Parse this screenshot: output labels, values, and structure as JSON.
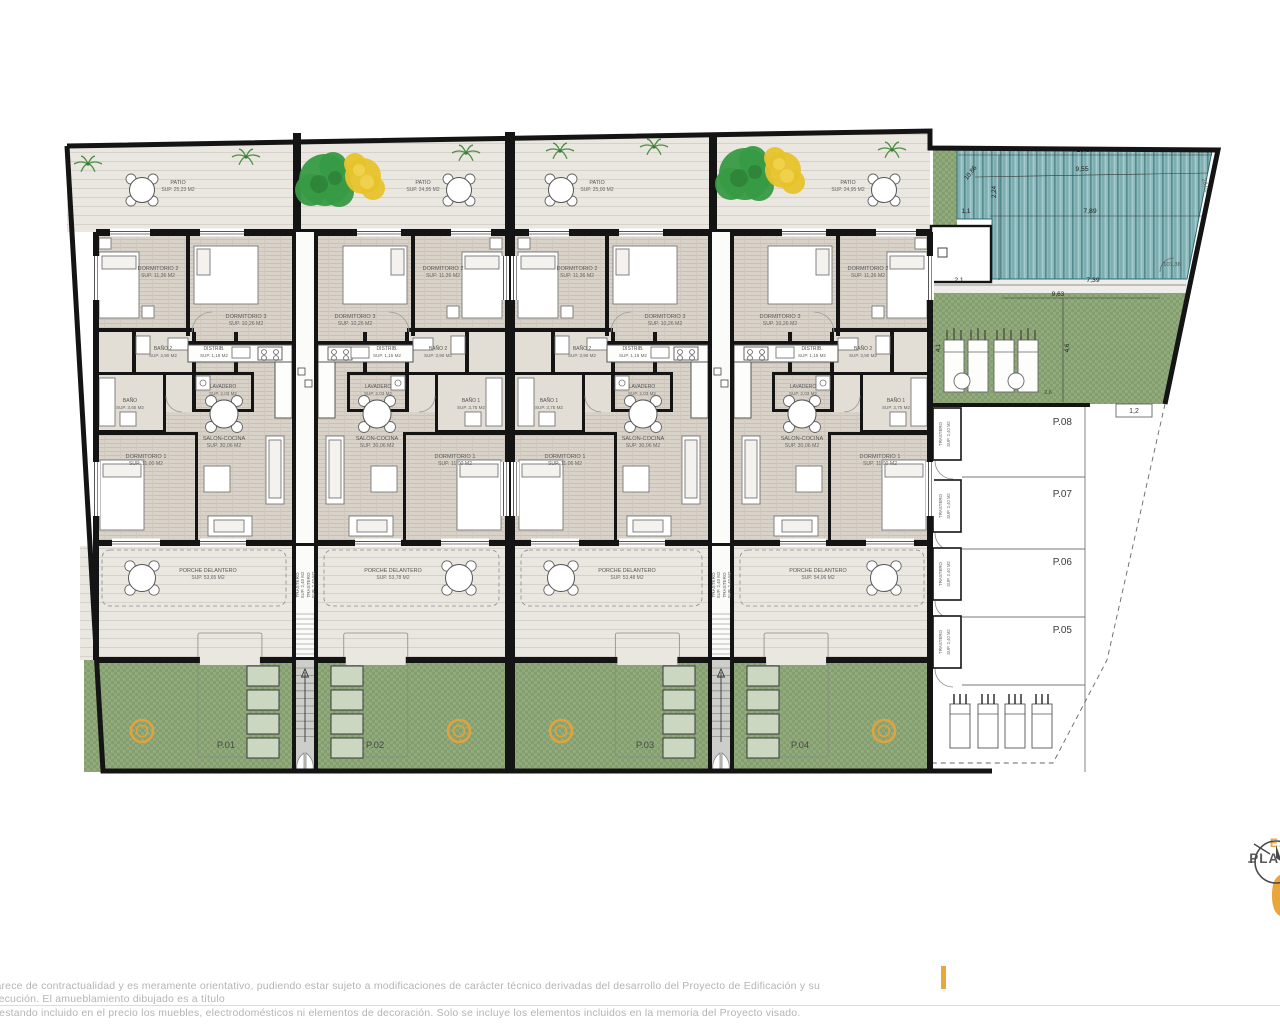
{
  "plan": {
    "units": [
      {
        "id": "P.01",
        "patio": {
          "name": "PATIO",
          "sup": "SUP. 25,23 M2"
        },
        "porche": {
          "name": "PORCHE DELANTERO",
          "sup": "SUP. 53,65 M2"
        },
        "rooms": {
          "dorm2": {
            "name": "DORMITORIO 2",
            "sup": "SUP. 11,36 M2"
          },
          "dorm3": {
            "name": "DORMITORIO 3",
            "sup": "SUP. 10,26 M2"
          },
          "bano2": {
            "name": "BAÑO 2",
            "sup": "SUP. 3,90 M2"
          },
          "distrib": {
            "name": "DISTRIB.",
            "sup": "SUP. 1,15 M2"
          },
          "lavadero": {
            "name": "LAVADERO",
            "sup": "SUP. 2,03 M2"
          },
          "banomid": {
            "name": "BAÑO",
            "sup": "SUP. 3,65 M2"
          },
          "dorm1": {
            "name": "DORMITORIO 1",
            "sup": "SUP. 11,00 M2"
          },
          "salon": {
            "name": "SALON-COCINA",
            "sup": "SUP. 30,06 M2"
          }
        }
      },
      {
        "id": "P.02",
        "patio": {
          "name": "PATIO",
          "sup": "SUP. 24,95 M2"
        },
        "porche": {
          "name": "PORCHE DELANTERO",
          "sup": "SUP. 53,78 M2"
        },
        "rooms": {
          "dorm2": {
            "name": "DORMITORIO 2",
            "sup": "SUP. 11,36 M2"
          },
          "dorm3": {
            "name": "DORMITORIO 3",
            "sup": "SUP. 10,26 M2"
          },
          "bano2": {
            "name": "BAÑO 2",
            "sup": "SUP. 3,90 M2"
          },
          "distrib": {
            "name": "DISTRIB.",
            "sup": "SUP. 1,15 M2"
          },
          "lavadero": {
            "name": "LAVADERO",
            "sup": "SUP. 2,03 M2"
          },
          "banomid": {
            "name": "BAÑO 1",
            "sup": "SUP. 3,75 M2"
          },
          "dorm1": {
            "name": "DORMITORIO 1",
            "sup": "SUP. 11,00 M2"
          },
          "salon": {
            "name": "SALON-COCINA",
            "sup": "SUP. 30,06 M2"
          }
        }
      },
      {
        "id": "P.03",
        "patio": {
          "name": "PATIO",
          "sup": "SUP. 25,00 M2"
        },
        "porche": {
          "name": "PORCHE DELANTERO",
          "sup": "SUP. 53,48 M2"
        },
        "rooms": {
          "dorm2": {
            "name": "DORMITORIO 2",
            "sup": "SUP. 11,36 M2"
          },
          "dorm3": {
            "name": "DORMITORIO 3",
            "sup": "SUP. 10,26 M2"
          },
          "bano2": {
            "name": "BAÑO 2",
            "sup": "SUP. 3,90 M2"
          },
          "distrib": {
            "name": "DISTRIB.",
            "sup": "SUP. 1,15 M2"
          },
          "lavadero": {
            "name": "LAVADERO",
            "sup": "SUP. 2,03 M2"
          },
          "banomid": {
            "name": "BAÑO 1",
            "sup": "SUP. 3,75 M2"
          },
          "dorm1": {
            "name": "DORMITORIO 1",
            "sup": "SUP. 11,06 M2"
          },
          "salon": {
            "name": "SALON-COCINA",
            "sup": "SUP. 30,06 M2"
          }
        }
      },
      {
        "id": "P.04",
        "patio": {
          "name": "PATIO",
          "sup": "SUP. 24,95 M2"
        },
        "porche": {
          "name": "PORCHE DELANTERO",
          "sup": "SUP. 54,06 M2"
        },
        "rooms": {
          "dorm2": {
            "name": "DORMITORIO 2",
            "sup": "SUP. 11,36 M2"
          },
          "dorm3": {
            "name": "DORMITORIO 3",
            "sup": "SUP. 10,26 M2"
          },
          "bano2": {
            "name": "BAÑO 2",
            "sup": "SUP. 3,90 M2"
          },
          "distrib": {
            "name": "DISTRIB.",
            "sup": "SUP. 1,15 M2"
          },
          "lavadero": {
            "name": "LAVADERO",
            "sup": "SUP. 2,03 M2"
          },
          "banomid": {
            "name": "BAÑO 1",
            "sup": "SUP. 3,75 M2"
          },
          "dorm1": {
            "name": "DORMITORIO 1",
            "sup": "SUP. 11,00 M2"
          },
          "salon": {
            "name": "SALON-COCINA",
            "sup": "SUP. 30,06 M2"
          }
        }
      }
    ],
    "stairwell_trastero": {
      "name": "TRASTERO",
      "sup": "SUP. 2,40 M2"
    },
    "parking": {
      "spaces": [
        {
          "id": "P.08"
        },
        {
          "id": "P.07"
        },
        {
          "id": "P.06"
        },
        {
          "id": "P.05"
        }
      ],
      "trastero": {
        "name": "TRASTERO",
        "sup": "SUP. 2,40 M2"
      }
    },
    "dimensions": {
      "pool_top": "10,87",
      "pool_second": "9,55",
      "pool_diag": "10,86",
      "pool_mid": "7,89",
      "pool_left": "1,1",
      "pool_vert": "2,24",
      "pool_bottom_left": "2,1",
      "pool_bottom": "7,39",
      "pool_side": "28,09",
      "pool_angle": "101,36",
      "solar_w": "9,63",
      "solar_h": "4,6",
      "solar_left": "4,1",
      "solar_small": "2,6",
      "parking_gap": "1,2"
    }
  },
  "footer": {
    "disclaimer_line1": "carece de contractualidad y es meramente orientativo, pudiendo estar sujeto a modificaciones de carácter técnico derivadas del desarrollo del Proyecto de Edificación y su ejecución. El amueblamiento dibujado es a título",
    "disclaimer_line2": "o estando incluido en el precio los muebles, electrodomésticos ni elementos de decoración. Solo se incluye los elementos incluidos en la memoria del Proyecto visado."
  },
  "title_block": {
    "scale": "E:1",
    "title": "PLAN",
    "number": "0"
  },
  "colors": {
    "accent_orange": "#e9a63b",
    "garden_green": "#90aa7c",
    "pool_teal": "#84b5b7",
    "wall_black": "#141414",
    "text_gray": "#58595b",
    "disclaimer_gray": "#b4b4b4"
  }
}
